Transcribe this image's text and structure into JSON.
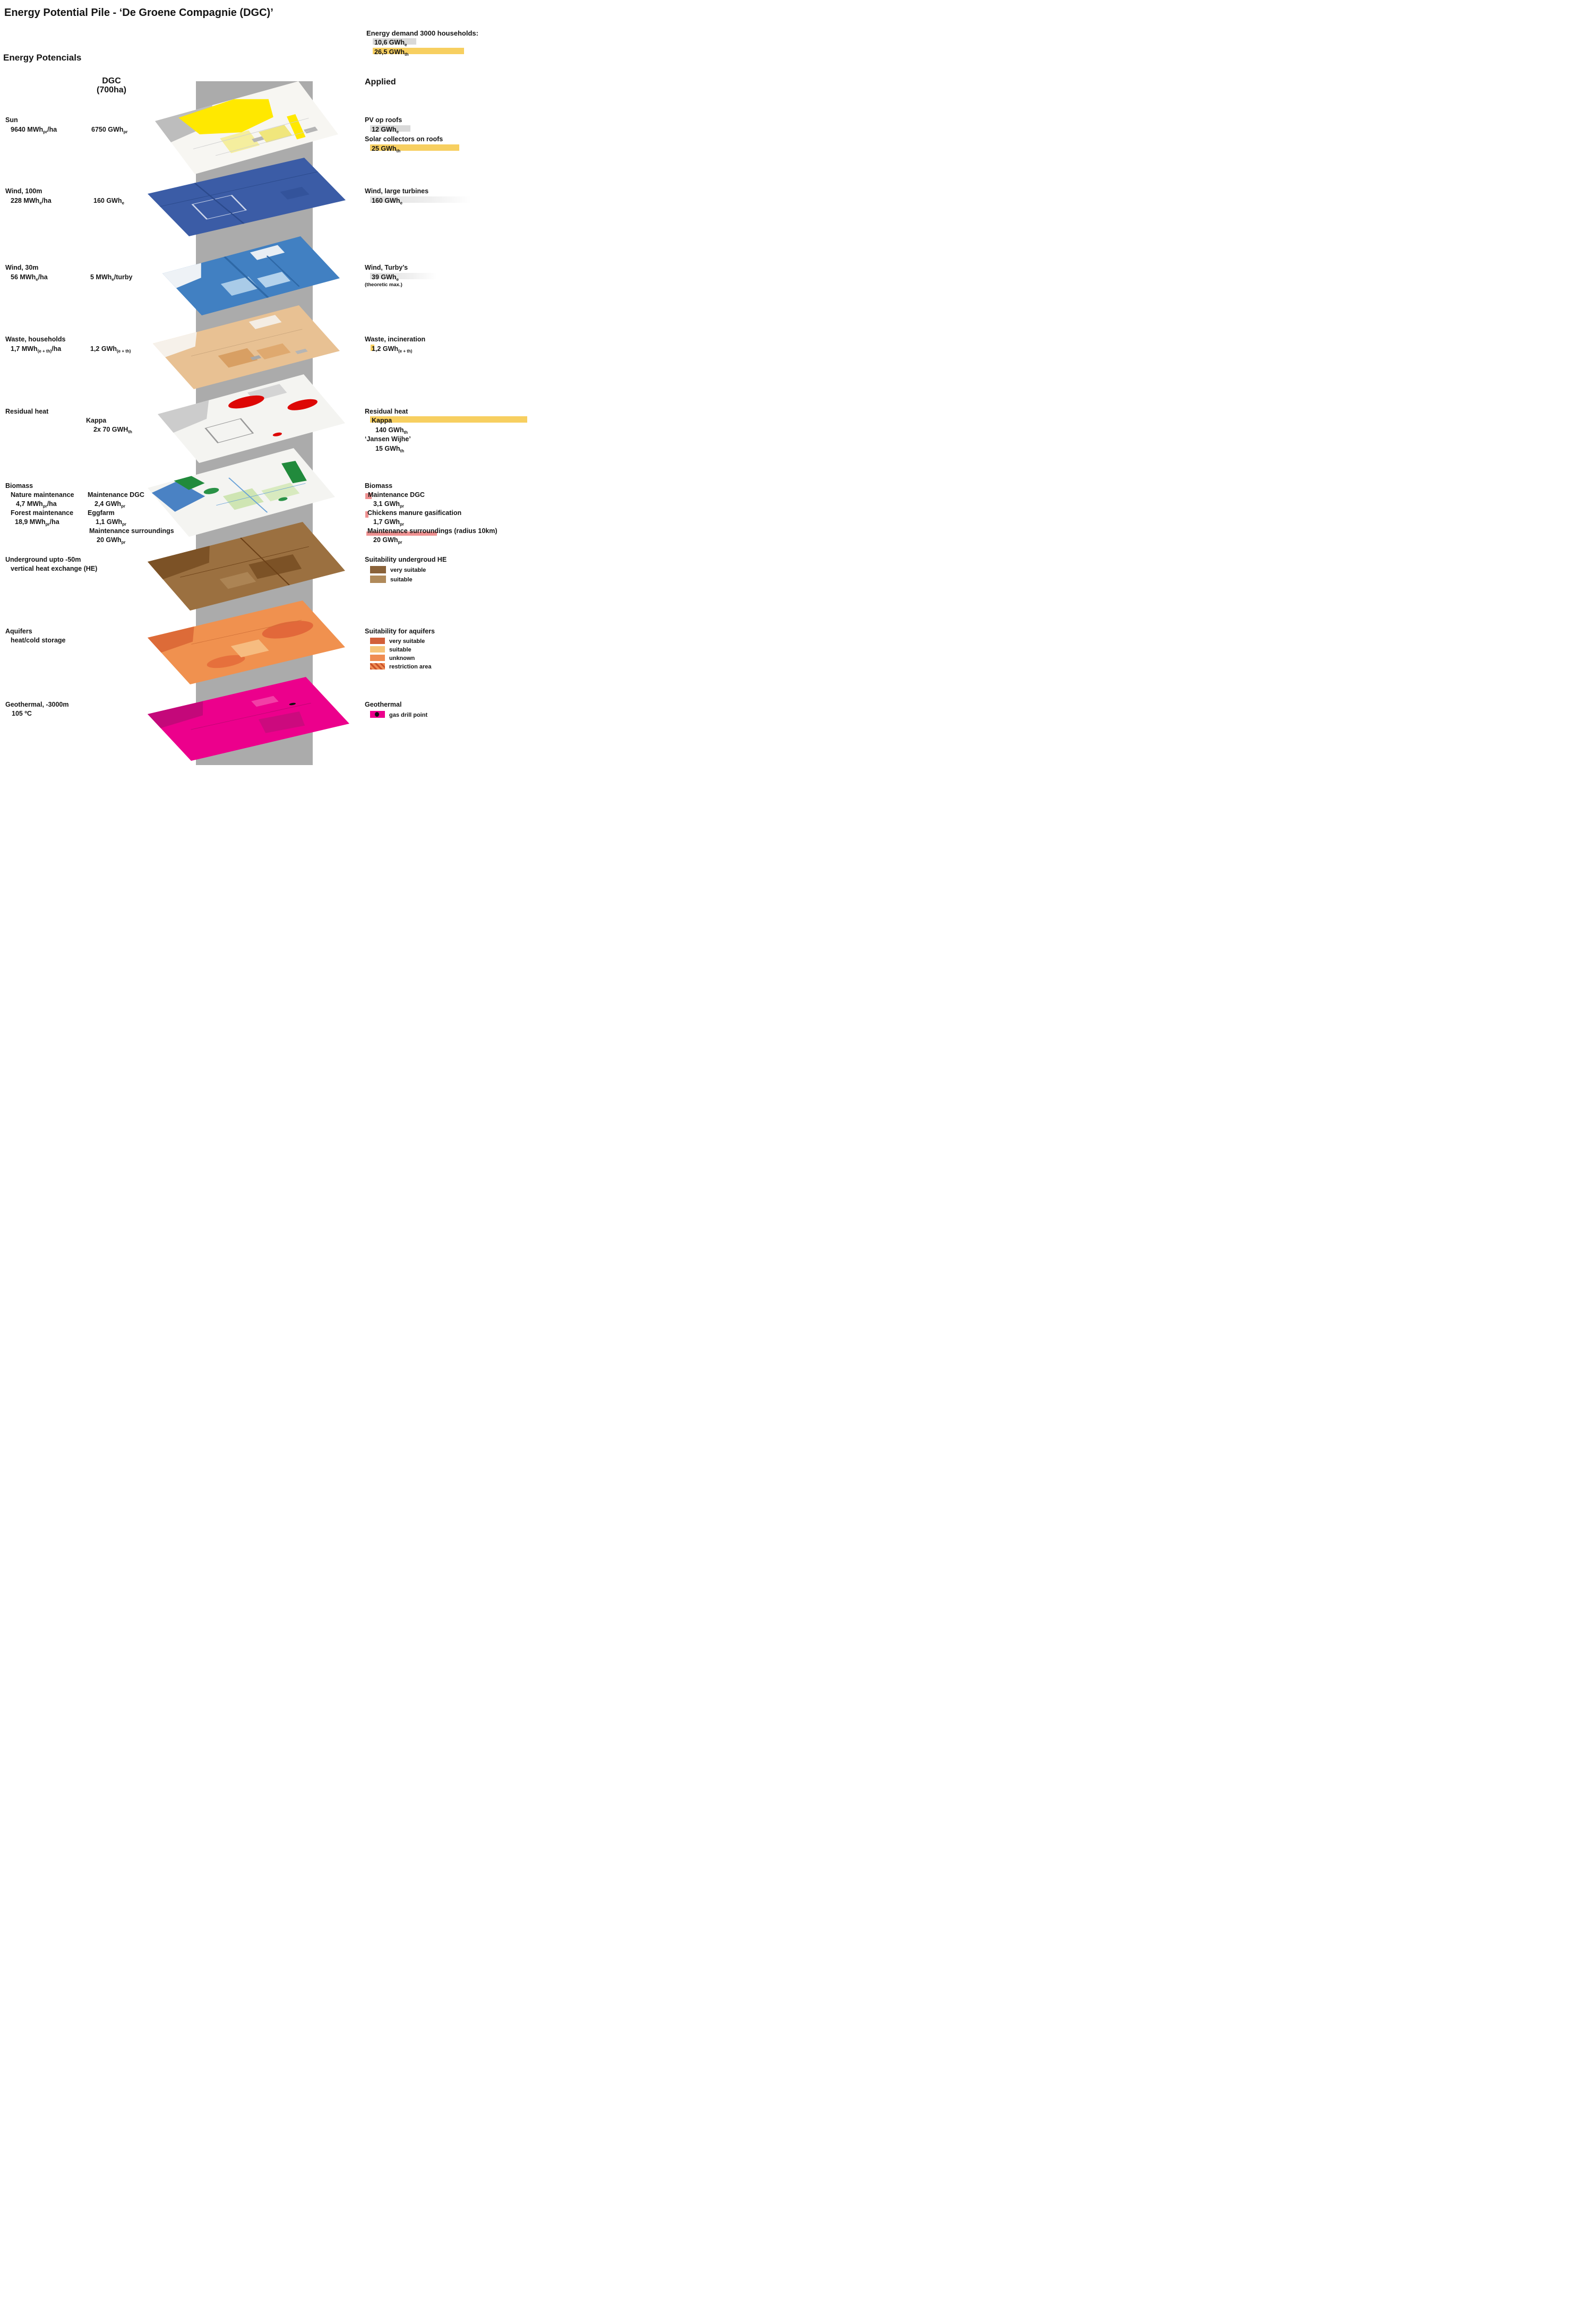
{
  "title": "Energy Potential Pile - ‘De Groene Compagnie (DGC)’",
  "section_heading": "Energy Potencials",
  "demand": {
    "heading": "Energy demand 3000 households:",
    "electric": {
      "pre": "10,6 GWh",
      "sub": "e"
    },
    "thermal": {
      "pre": "26,5 GWh",
      "sub": "th"
    }
  },
  "columns": {
    "dgc_line1": "DGC",
    "dgc_line2": "(700ha)",
    "applied": "Applied"
  },
  "rows": {
    "sun": {
      "label": "Sun",
      "per_ha": {
        "pre": "9640 MWh",
        "sub": "pr",
        "post": "/ha"
      },
      "dgc_total": {
        "pre": "6750 GWh",
        "sub": "pr"
      },
      "applied": {
        "item1": "PV op roofs",
        "value1": {
          "pre": "12 GWh",
          "sub": "e"
        },
        "item2": "Solar collectors on roofs",
        "value2": {
          "pre": "25 GWh",
          "sub": "th"
        }
      }
    },
    "wind_100m": {
      "label": "Wind, 100m",
      "per_ha": {
        "pre": "228 MWh",
        "sub": "e",
        "post": "/ha"
      },
      "dgc_total": {
        "pre": "160 GWh",
        "sub": "e"
      },
      "applied": {
        "item": "Wind, large turbines",
        "value": {
          "pre": "160 GWh",
          "sub": "e"
        }
      }
    },
    "wind_30m": {
      "label": "Wind, 30m",
      "per_ha": {
        "pre": "56 MWh",
        "sub": "e",
        "post": "/ha"
      },
      "per_turby": {
        "pre": "5 MWh",
        "sub": "e",
        "post": "/turby"
      },
      "applied": {
        "item": "Wind, Turby’s",
        "value": {
          "pre": "39 GWh",
          "sub": "e"
        },
        "note": "(theoretic max.)"
      }
    },
    "waste": {
      "label": "Waste, households",
      "per_ha": {
        "pre": "1,7 MWh",
        "sub": "(e + th)",
        "post": "/ha"
      },
      "dgc_total": {
        "pre": "1,2 GWh",
        "sub": "(e + th)"
      },
      "applied": {
        "item": "Waste, incineration",
        "value": {
          "pre": "1,2 GWh",
          "sub": "(e + th)"
        }
      }
    },
    "residual_heat": {
      "label": "Residual heat",
      "source": "Kappa",
      "dgc_total": {
        "pre": "2x 70 GWH",
        "sub": "th"
      },
      "applied": {
        "item": "Residual heat",
        "source1": "Kappa",
        "value1": {
          "pre": "140 GWh",
          "sub": "th"
        },
        "source2": "‘Jansen Wijhe’",
        "value2": {
          "pre": "15 GWh",
          "sub": "th"
        }
      }
    },
    "biomass": {
      "label": "Biomass",
      "sub1": "Nature maintenance",
      "sub1_value": {
        "pre": "4,7 MWh",
        "sub": "pr",
        "post": "/ha"
      },
      "sub2": "Forest maintenance",
      "sub2_value": {
        "pre": "18,9 MWh",
        "sub": "pr",
        "post": "/ha"
      },
      "dgc": {
        "item1": "Maintenance DGC",
        "value1": {
          "pre": "2,4 GWh",
          "sub": "pr"
        },
        "item2": "Eggfarm",
        "value2": {
          "pre": "1,1 GWh",
          "sub": "pr"
        },
        "item3": "Maintenance surroundings",
        "value3": {
          "pre": "20 GWh",
          "sub": "pr"
        }
      },
      "applied": {
        "item1": "Maintenance DGC",
        "value1": {
          "pre": "3,1 GWh",
          "sub": "pr"
        },
        "item2": "Chickens manure gasification",
        "value2": {
          "pre": "1,7 GWh",
          "sub": "pr"
        },
        "item3": "Maintenance surroundings (radius 10km)",
        "value3": {
          "pre": "20 GWh",
          "sub": "pr"
        }
      }
    },
    "underground": {
      "label1": "Underground upto -50m",
      "label2": "vertical heat exchange (HE)",
      "legend": {
        "title": "Suitability undergroud HE",
        "items": [
          {
            "label": "very suitable",
            "color": "#8a6239"
          },
          {
            "label": "suitable",
            "color": "#b08a5a"
          }
        ]
      }
    },
    "aquifers": {
      "label1": "Aquifers",
      "label2": "heat/cold storage",
      "legend": {
        "title": "Suitability for aquifers",
        "items": [
          {
            "label": "very suitable",
            "color": "#d2603a"
          },
          {
            "label": "suitable",
            "color": "#f6c478"
          },
          {
            "label": "unknown",
            "color": "#ef8c52"
          },
          {
            "label": "restriction area",
            "color": "striped #c8502a on #ef8c52"
          }
        ]
      }
    },
    "geothermal": {
      "label1": "Geothermal, -3000m",
      "label2": "105 ºC",
      "legend": {
        "title": "Geothermal",
        "item": "gas drill point"
      }
    }
  },
  "colors": {
    "hl-yellow": "#f7cf60",
    "hl-grey": "#d9d9d9",
    "hl-pink": "#ef9191",
    "grad-grey": "#e0e0e0",
    "band-grey": "#ababab",
    "red-spot": "#dd0806",
    "brown-very": "#8a6239",
    "brown-suit": "#b08a5a",
    "aq-very": "#d2603a",
    "aq-suit": "#f6c478",
    "aq-unknown": "#ef8c52",
    "aq-stripe": "#c8502a",
    "geo-pink": "#ec008c",
    "map-sun": "#ffe800",
    "map-wind100": "#3b5ca6",
    "map-wind30": "#4180c2",
    "map-waste": "#e8c193",
    "map-underground": "#9b7040",
    "map-aquifer": "#f0914f",
    "map-bio-green": "#218a3c"
  }
}
